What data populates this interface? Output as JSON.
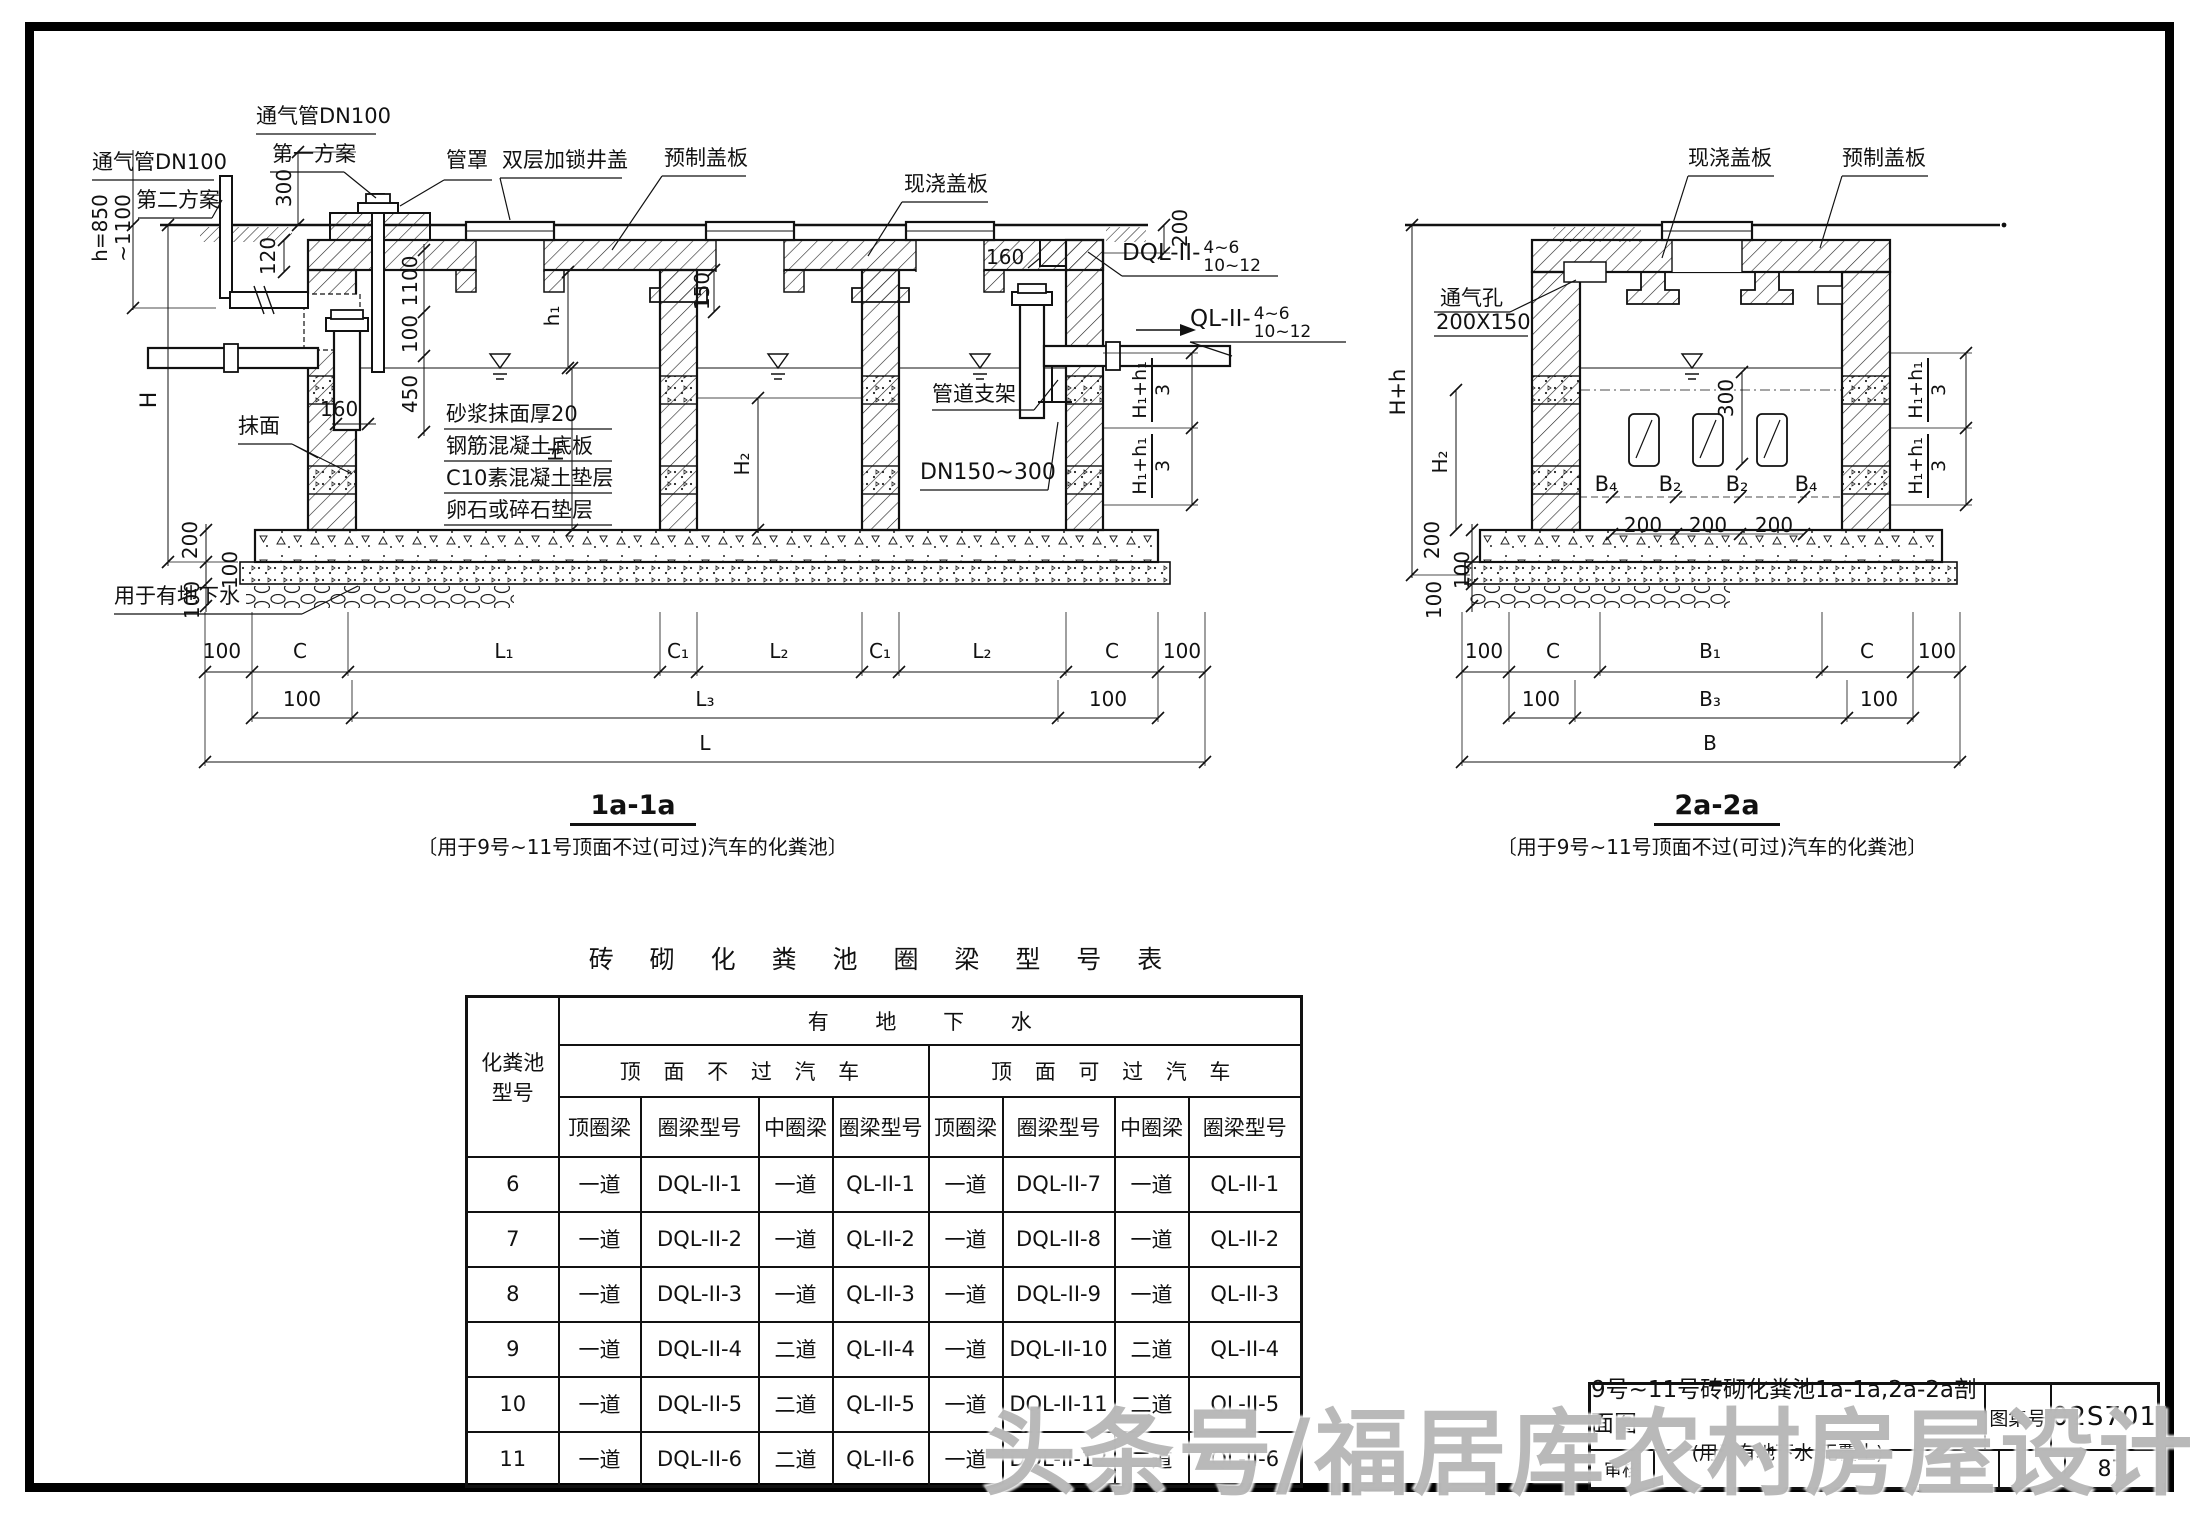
{
  "watermark": "头条号/福居库农村房屋设计",
  "dim": {
    "100": "100",
    "120": "120",
    "150": "150",
    "160": "160",
    "200": "200",
    "300": "300",
    "450": "450",
    "1100": "1100",
    "hr1": "h=850",
    "hr2": "~1100"
  },
  "sym": {
    "H": "H",
    "H1": "H₁",
    "H2": "H₂",
    "h1": "h₁",
    "Hh": "H+h",
    "H1h1": "H₁+h₁",
    "three": "3",
    "L": "L",
    "L1": "L₁",
    "L2": "L₂",
    "L3": "L₃",
    "C": "C",
    "C1": "C₁",
    "B": "B",
    "B1": "B₁",
    "B2": "B₂",
    "B3": "B₃",
    "B4": "B₄"
  },
  "section1": {
    "title": "1a-1a",
    "caption": "〔用于9号~11号顶面不过(可过)汽车的化粪池〕",
    "labels": {
      "vent2_1": "通气管DN100",
      "vent2_2": "第二方案",
      "vent1_1": "通气管DN100",
      "vent1_2": "第一方案",
      "pipe_cap": "管罩",
      "double_cover": "双层加锁井盖",
      "precast_slab": "预制盖板",
      "cast_slab": "现浇盖板",
      "plaster": "抹面",
      "groundwater": "用于有地下水",
      "pipe_support": "管道支架",
      "pipe_dn": "DN150~300",
      "layer1": "砂浆抹面厚20",
      "layer2": "钢筋混凝土底板",
      "layer3": "C10素混凝土垫层",
      "layer4": "卵石或碎石垫层",
      "dql": "DQL-II-",
      "ql": "QL-II-",
      "range_top": "4~6",
      "range_bottom": "10~12"
    }
  },
  "section2": {
    "title": "2a-2a",
    "caption": "〔用于9号~11号顶面不过(可过)汽车的化粪池〕",
    "labels": {
      "cast_slab": "现浇盖板",
      "precast_slab": "预制盖板",
      "vent_hole": "通气孔",
      "vent_size": "200X150"
    }
  },
  "table": {
    "title": "砖 砌 化 粪 池 圈 梁 型 号 表",
    "col1_l1": "化粪池",
    "col1_l2": "型号",
    "group_top": "有 地 下 水",
    "group_left": "顶 面 不 过 汽 车",
    "group_right": "顶 面 可 过 汽 车",
    "sub": [
      "顶圈梁",
      "圈梁型号",
      "中圈梁",
      "圈梁型号",
      "顶圈梁",
      "圈梁型号",
      "中圈梁",
      "圈梁型号"
    ],
    "rows": [
      [
        "6",
        "一道",
        "DQL-II-1",
        "一道",
        "QL-II-1",
        "一道",
        "DQL-II-7",
        "一道",
        "QL-II-1"
      ],
      [
        "7",
        "一道",
        "DQL-II-2",
        "一道",
        "QL-II-2",
        "一道",
        "DQL-II-8",
        "一道",
        "QL-II-2"
      ],
      [
        "8",
        "一道",
        "DQL-II-3",
        "一道",
        "QL-II-3",
        "一道",
        "DQL-II-9",
        "一道",
        "QL-II-3"
      ],
      [
        "9",
        "一道",
        "DQL-II-4",
        "二道",
        "QL-II-4",
        "一道",
        "DQL-II-10",
        "二道",
        "QL-II-4"
      ],
      [
        "10",
        "一道",
        "DQL-II-5",
        "二道",
        "QL-II-5",
        "一道",
        "DQL-II-11",
        "二道",
        "QL-II-5"
      ],
      [
        "11",
        "一道",
        "DQL-II-6",
        "二道",
        "QL-II-6",
        "一道",
        "DQL-II-12",
        "二道",
        "QL-II-6"
      ]
    ]
  },
  "titleblock": {
    "title_l1": "9号~11号砖砌化粪池1a-1a,2a-2a剖面图",
    "title_l2": "(用于有地下水 无覆土)",
    "atlas_label": "图集号",
    "atlas_no": "02S701",
    "review_label": "审核",
    "page_no": "87"
  }
}
